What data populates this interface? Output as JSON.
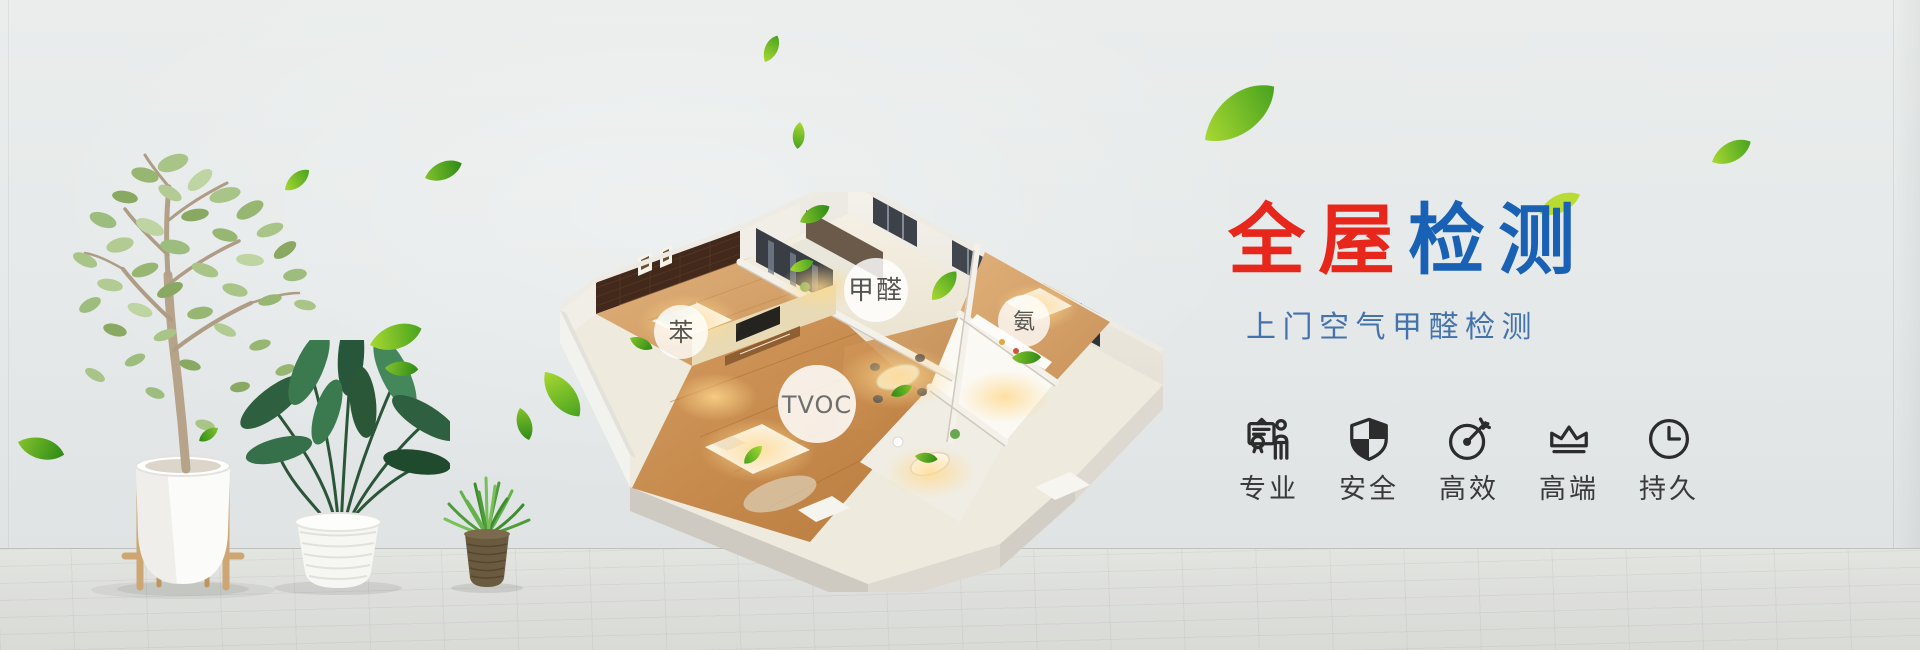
{
  "hero": {
    "title": {
      "red_text": "全屋",
      "blue_text": "检测"
    },
    "subtitle": "上门空气甲醛检测"
  },
  "house_labels": {
    "formaldehyde": "甲醛",
    "benzene": "苯",
    "ammonia": "氨",
    "tvoc": "TVOC"
  },
  "features": {
    "items": [
      {
        "icon": "certificate-person-icon",
        "label": "专业"
      },
      {
        "icon": "shield-icon",
        "label": "安全"
      },
      {
        "icon": "target-dart-icon",
        "label": "高效"
      },
      {
        "icon": "crown-icon",
        "label": "高端"
      },
      {
        "icon": "clock-icon",
        "label": "持久"
      }
    ]
  },
  "colors": {
    "title_red": "#e7261c",
    "title_blue": "#1961b5",
    "subtitle_blue": "#4473ac",
    "feature_text": "#3a3a3a",
    "icon_stroke": "#2c2c2c",
    "leaf_green": "#5cb32a",
    "background": "#e6e9e9"
  }
}
